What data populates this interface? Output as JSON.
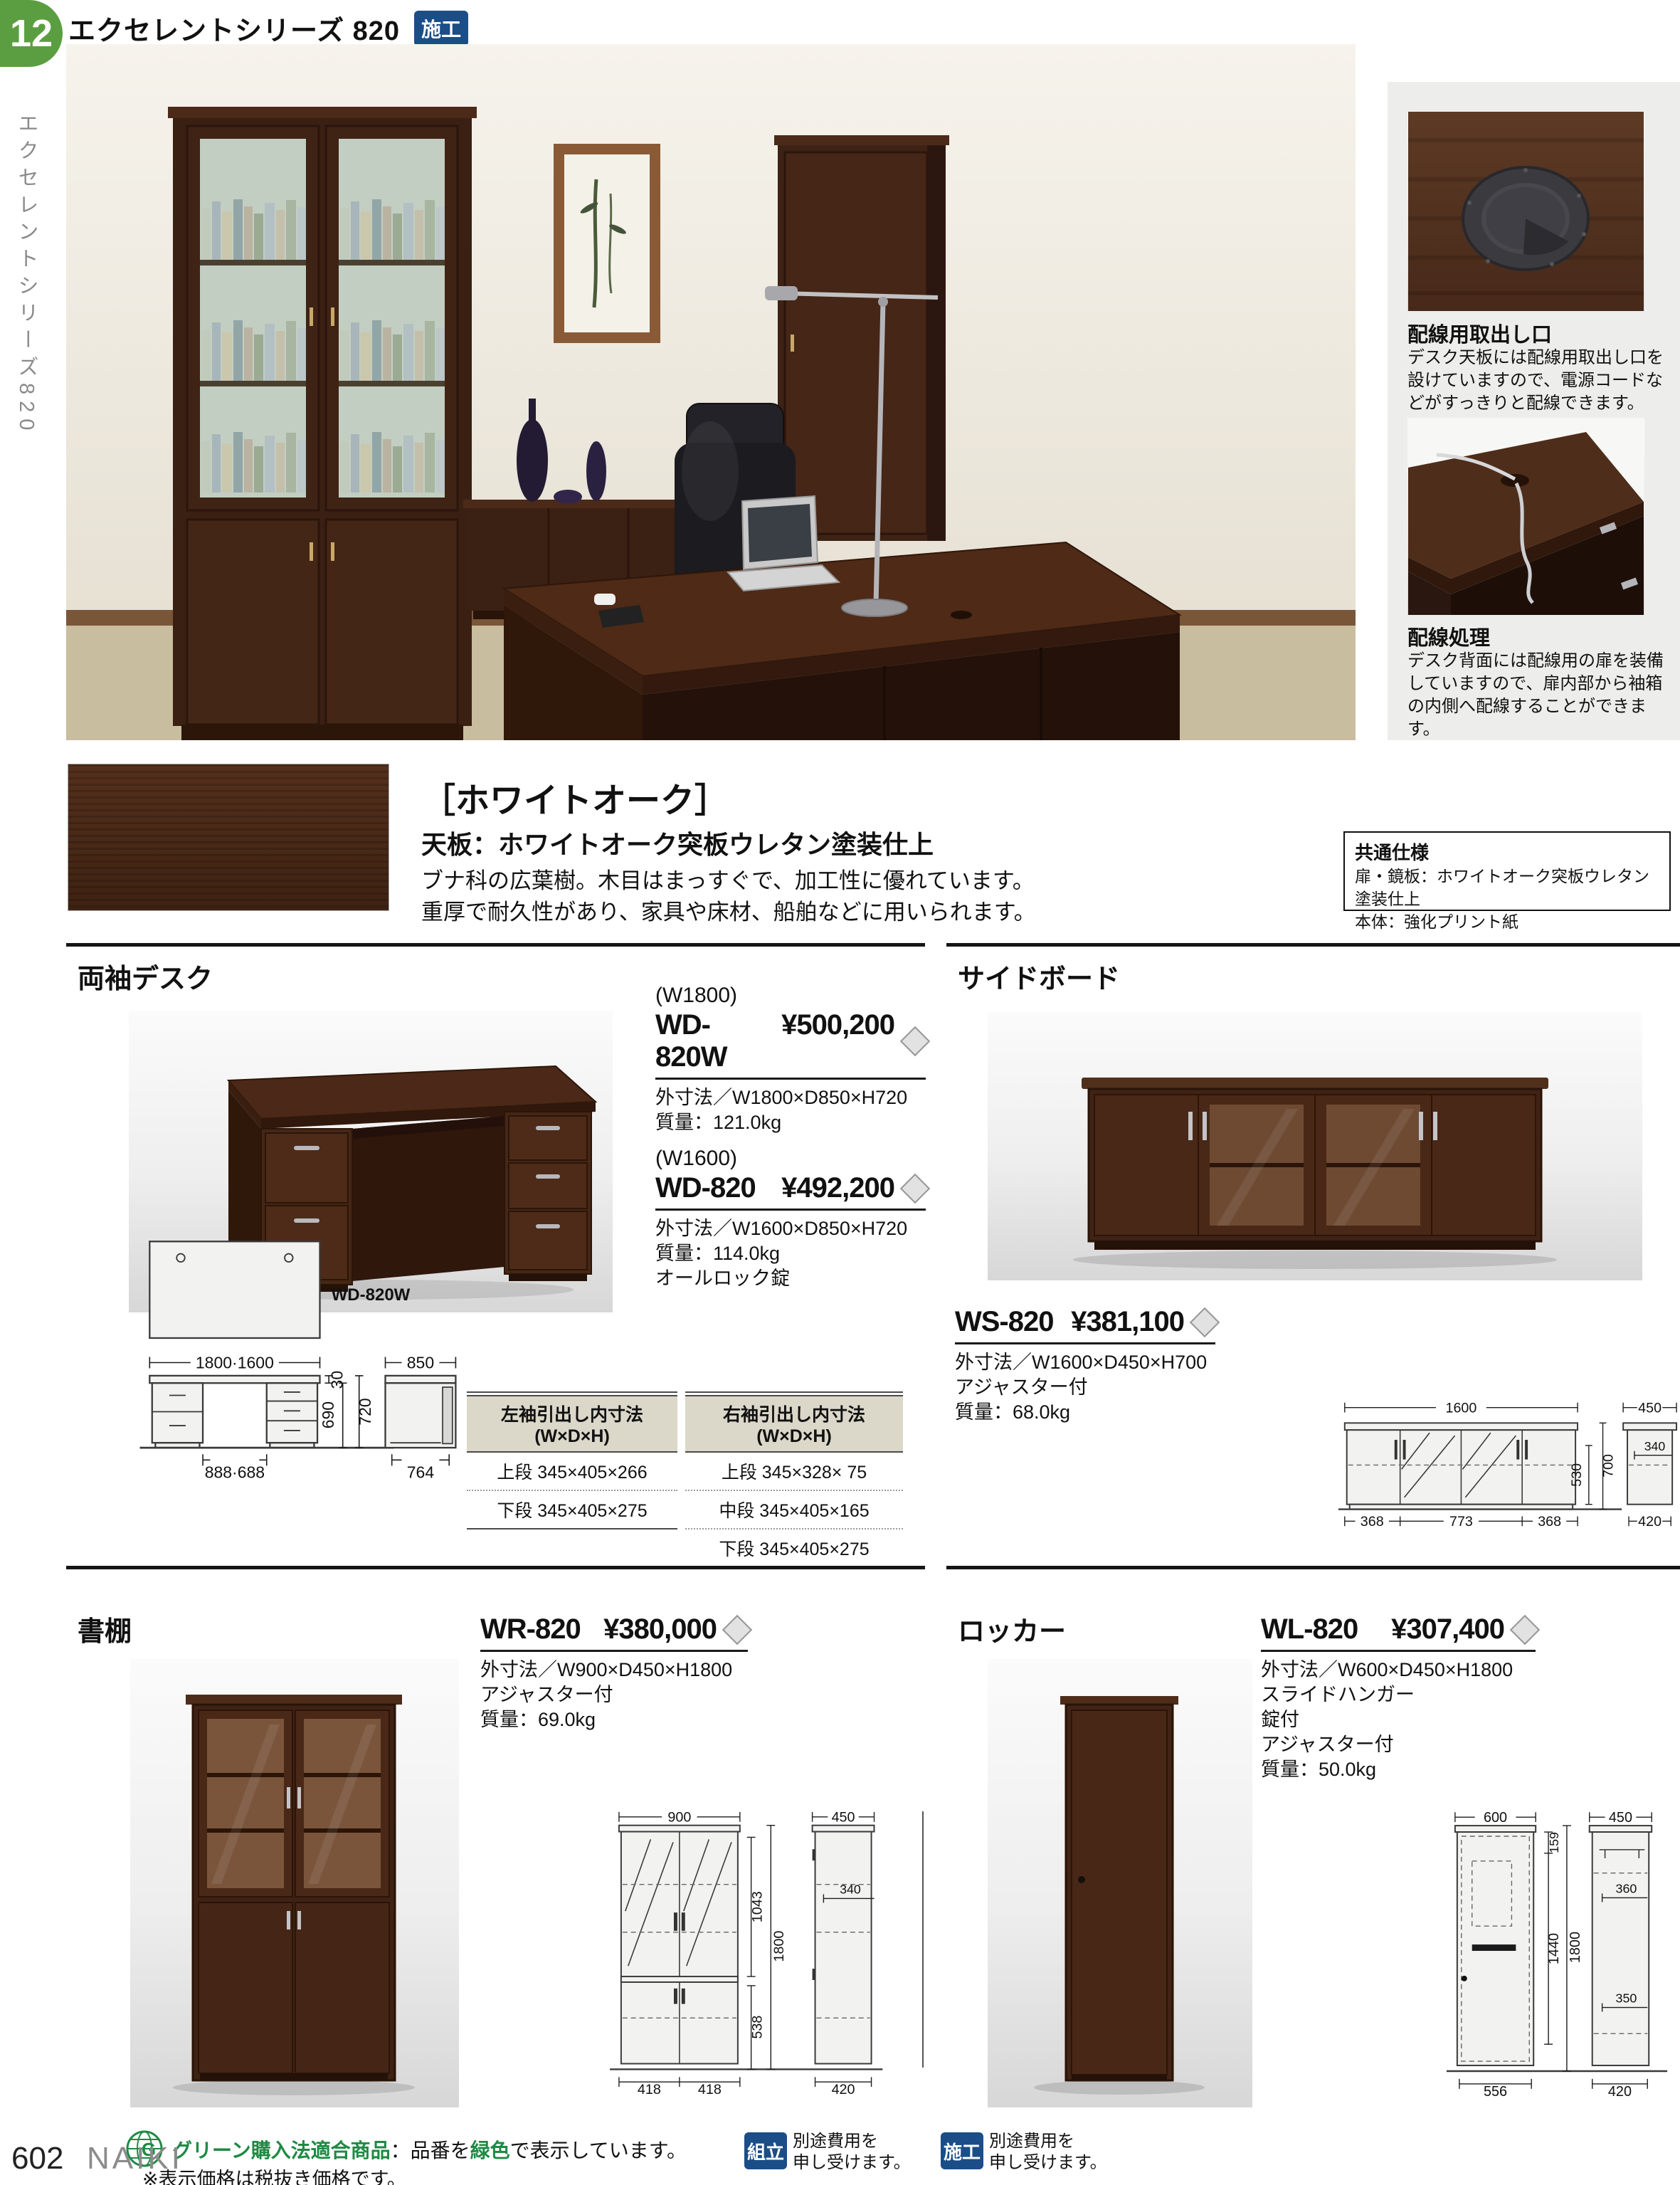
{
  "header": {
    "tab": "12",
    "title": "エクセレントシリーズ 820",
    "badge": "施工"
  },
  "sidebar": {
    "series": "エクセレントシリーズ820"
  },
  "features": [
    {
      "title": "配線用取出し口",
      "body": "デスク天板には配線用取出し口を設けていますので、電源コードなどがすっきりと配線できます。"
    },
    {
      "title": "配線処理",
      "body": "デスク背面には配線用の扉を装備していますので、扉内部から袖箱の内側へ配線することができます。"
    }
  ],
  "finish": {
    "name": "［ホワイトオーク］",
    "subtitle": "天板：ホワイトオーク突板ウレタン塗装仕上",
    "desc1": "ブナ科の広葉樹。木目はまっすぐで、加工性に優れています。",
    "desc2": "重厚で耐久性があり、家具や床材、船舶などに用いられます。"
  },
  "common_spec": {
    "title": "共通仕様",
    "line1": "扉・鏡板：ホワイトオーク突板ウレタン塗装仕上",
    "line2": "本体：強化プリント紙"
  },
  "desk": {
    "title": "両袖デスク",
    "photo_label": "WD-820W",
    "products": [
      {
        "size": "(W1800)",
        "model": "WD-820W",
        "price": "¥500,200",
        "specs": [
          "外寸法／W1800×D850×H720",
          "質量：121.0kg"
        ]
      },
      {
        "size": "(W1600)",
        "model": "WD-820",
        "price": "¥492,200",
        "specs": [
          "外寸法／W1600×D850×H720",
          "質量：114.0kg",
          "オールロック錠"
        ]
      }
    ],
    "table_left": {
      "title": "左袖引出し内寸法 (W×D×H)",
      "rows": [
        "上段 345×405×266",
        "下段 345×405×275"
      ]
    },
    "table_right": {
      "title": "右袖引出し内寸法 (W×D×H)",
      "rows": [
        "上段 345×328× 75",
        "中段 345×405×165",
        "下段 345×405×275"
      ]
    },
    "dims": {
      "width": "1800·1600",
      "top": "30",
      "h1": "690",
      "h2": "720",
      "knee": "888·688",
      "depth": "850",
      "bottom": "764"
    }
  },
  "sideboard": {
    "title": "サイドボード",
    "model": "WS-820",
    "price": "¥381,100",
    "specs": [
      "外寸法／W1600×D450×H700",
      "アジャスター付",
      "質量：68.0kg"
    ],
    "dims": {
      "width": "1600",
      "b1": "368",
      "b2": "773",
      "b3": "368",
      "h1": "530",
      "h2": "700",
      "depth": "450",
      "inner": "340",
      "side_bottom": "420"
    }
  },
  "bookshelf": {
    "title": "書棚",
    "model": "WR-820",
    "price": "¥380,000",
    "specs": [
      "外寸法／W900×D450×H1800",
      "アジャスター付",
      "質量：69.0kg"
    ],
    "dims": {
      "width": "900",
      "h1": "1043",
      "h2": "1800",
      "h3": "538",
      "b1": "418",
      "b2": "418",
      "depth": "450",
      "inner": "340",
      "side_bottom": "420"
    }
  },
  "locker": {
    "title": "ロッカー",
    "model": "WL-820",
    "price": "¥307,400",
    "specs": [
      "外寸法／W600×D450×H1800",
      "スライドハンガー",
      "錠付",
      "アジャスター付",
      "質量：50.0kg"
    ],
    "dims": {
      "width": "600",
      "h1": "159",
      "h2": "1440",
      "h3": "1800",
      "b1": "556",
      "depth": "450",
      "inner1": "360",
      "inner2": "350",
      "side_bottom": "420"
    }
  },
  "footer": {
    "green_label": "グリーン購入法適合商品",
    "green_mid": "：品番を",
    "green_word": "緑色",
    "green_end": "で表示しています。",
    "badge1": "組立",
    "badge1_l1": "別途費用を",
    "badge1_l2": "申し受けます。",
    "badge2": "施工",
    "badge2_l1": "別途費用を",
    "badge2_l2": "申し受けます。",
    "note": "※表示価格は税抜き価格です。",
    "page_number": "602",
    "brand": "NAIKI"
  },
  "colors": {
    "accent_green": "#5b9e41",
    "badge_blue": "#1b4d87",
    "footer_green": "#1f8a44"
  }
}
